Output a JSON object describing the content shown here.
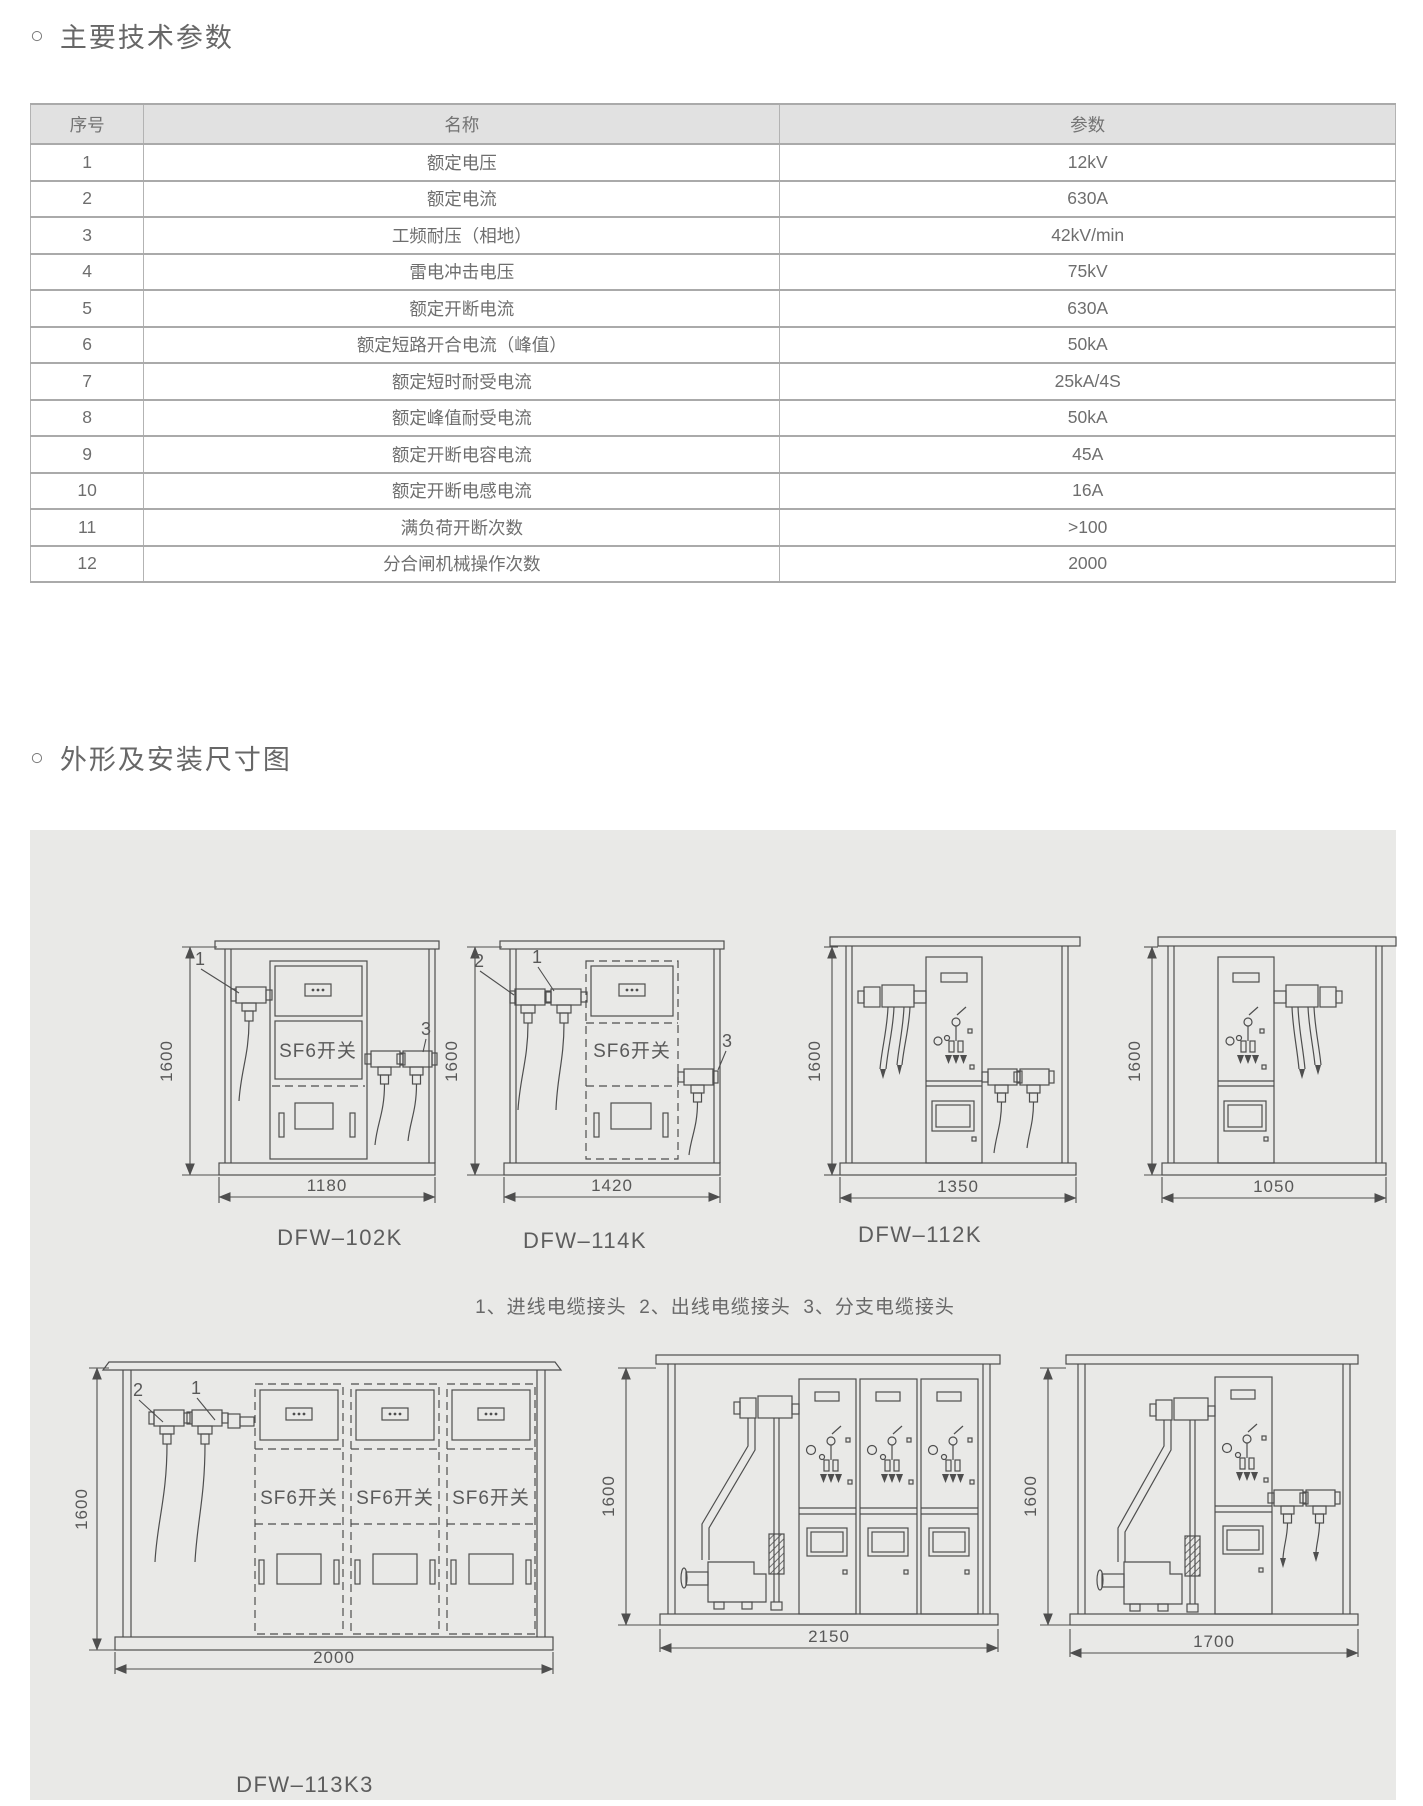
{
  "page": {
    "bullet": "○",
    "section1_title": "主要技术参数",
    "section2_title": "外形及安装尺寸图"
  },
  "table": {
    "headers": [
      "序号",
      "名称",
      "参数"
    ],
    "rows": [
      {
        "no": "1",
        "name": "额定电压",
        "value": "12kV"
      },
      {
        "no": "2",
        "name": "额定电流",
        "value": "630A"
      },
      {
        "no": "3",
        "name": "工频耐压（相地）",
        "value": "42kV/min"
      },
      {
        "no": "4",
        "name": "雷电冲击电压",
        "value": "75kV"
      },
      {
        "no": "5",
        "name": "额定开断电流",
        "value": "630A"
      },
      {
        "no": "6",
        "name": "额定短路开合电流（峰值）",
        "value": "50kA"
      },
      {
        "no": "7",
        "name": "额定短时耐受电流",
        "value": "25kA/4S"
      },
      {
        "no": "8",
        "name": "额定峰值耐受电流",
        "value": "50kA"
      },
      {
        "no": "9",
        "name": "额定开断电容电流",
        "value": "45A"
      },
      {
        "no": "10",
        "name": "额定开断电感电流",
        "value": "16A"
      },
      {
        "no": "11",
        "name": "满负荷开断次数",
        "value": ">100"
      },
      {
        "no": "12",
        "name": "分合闸机械操作次数",
        "value": "2000"
      }
    ]
  },
  "drawings": {
    "legend": "1、进线电缆接头  2、出线电缆接头  3、分支电缆接头",
    "sf6_label": "SF6开关",
    "height_dim": "1600",
    "callouts": {
      "in": "1",
      "out": "2",
      "branch": "3"
    },
    "models": {
      "dfw102k": {
        "caption": "DFW–102K",
        "width_dim": "1180"
      },
      "dfw114k": {
        "caption": "DFW–114K",
        "width_dim": "1420"
      },
      "dfw112k_front": {
        "caption": "DFW–112K",
        "width_dim": "1350"
      },
      "dfw112k_side": {
        "width_dim": "1050"
      },
      "dfw113k3": {
        "caption": "DFW–113K3",
        "width_dim": "2000"
      },
      "unit_2150": {
        "width_dim": "2150"
      },
      "unit_1700": {
        "width_dim": "1700"
      }
    },
    "panel_bg": "#e9e9e7",
    "line_color": "#4e4e4e"
  }
}
